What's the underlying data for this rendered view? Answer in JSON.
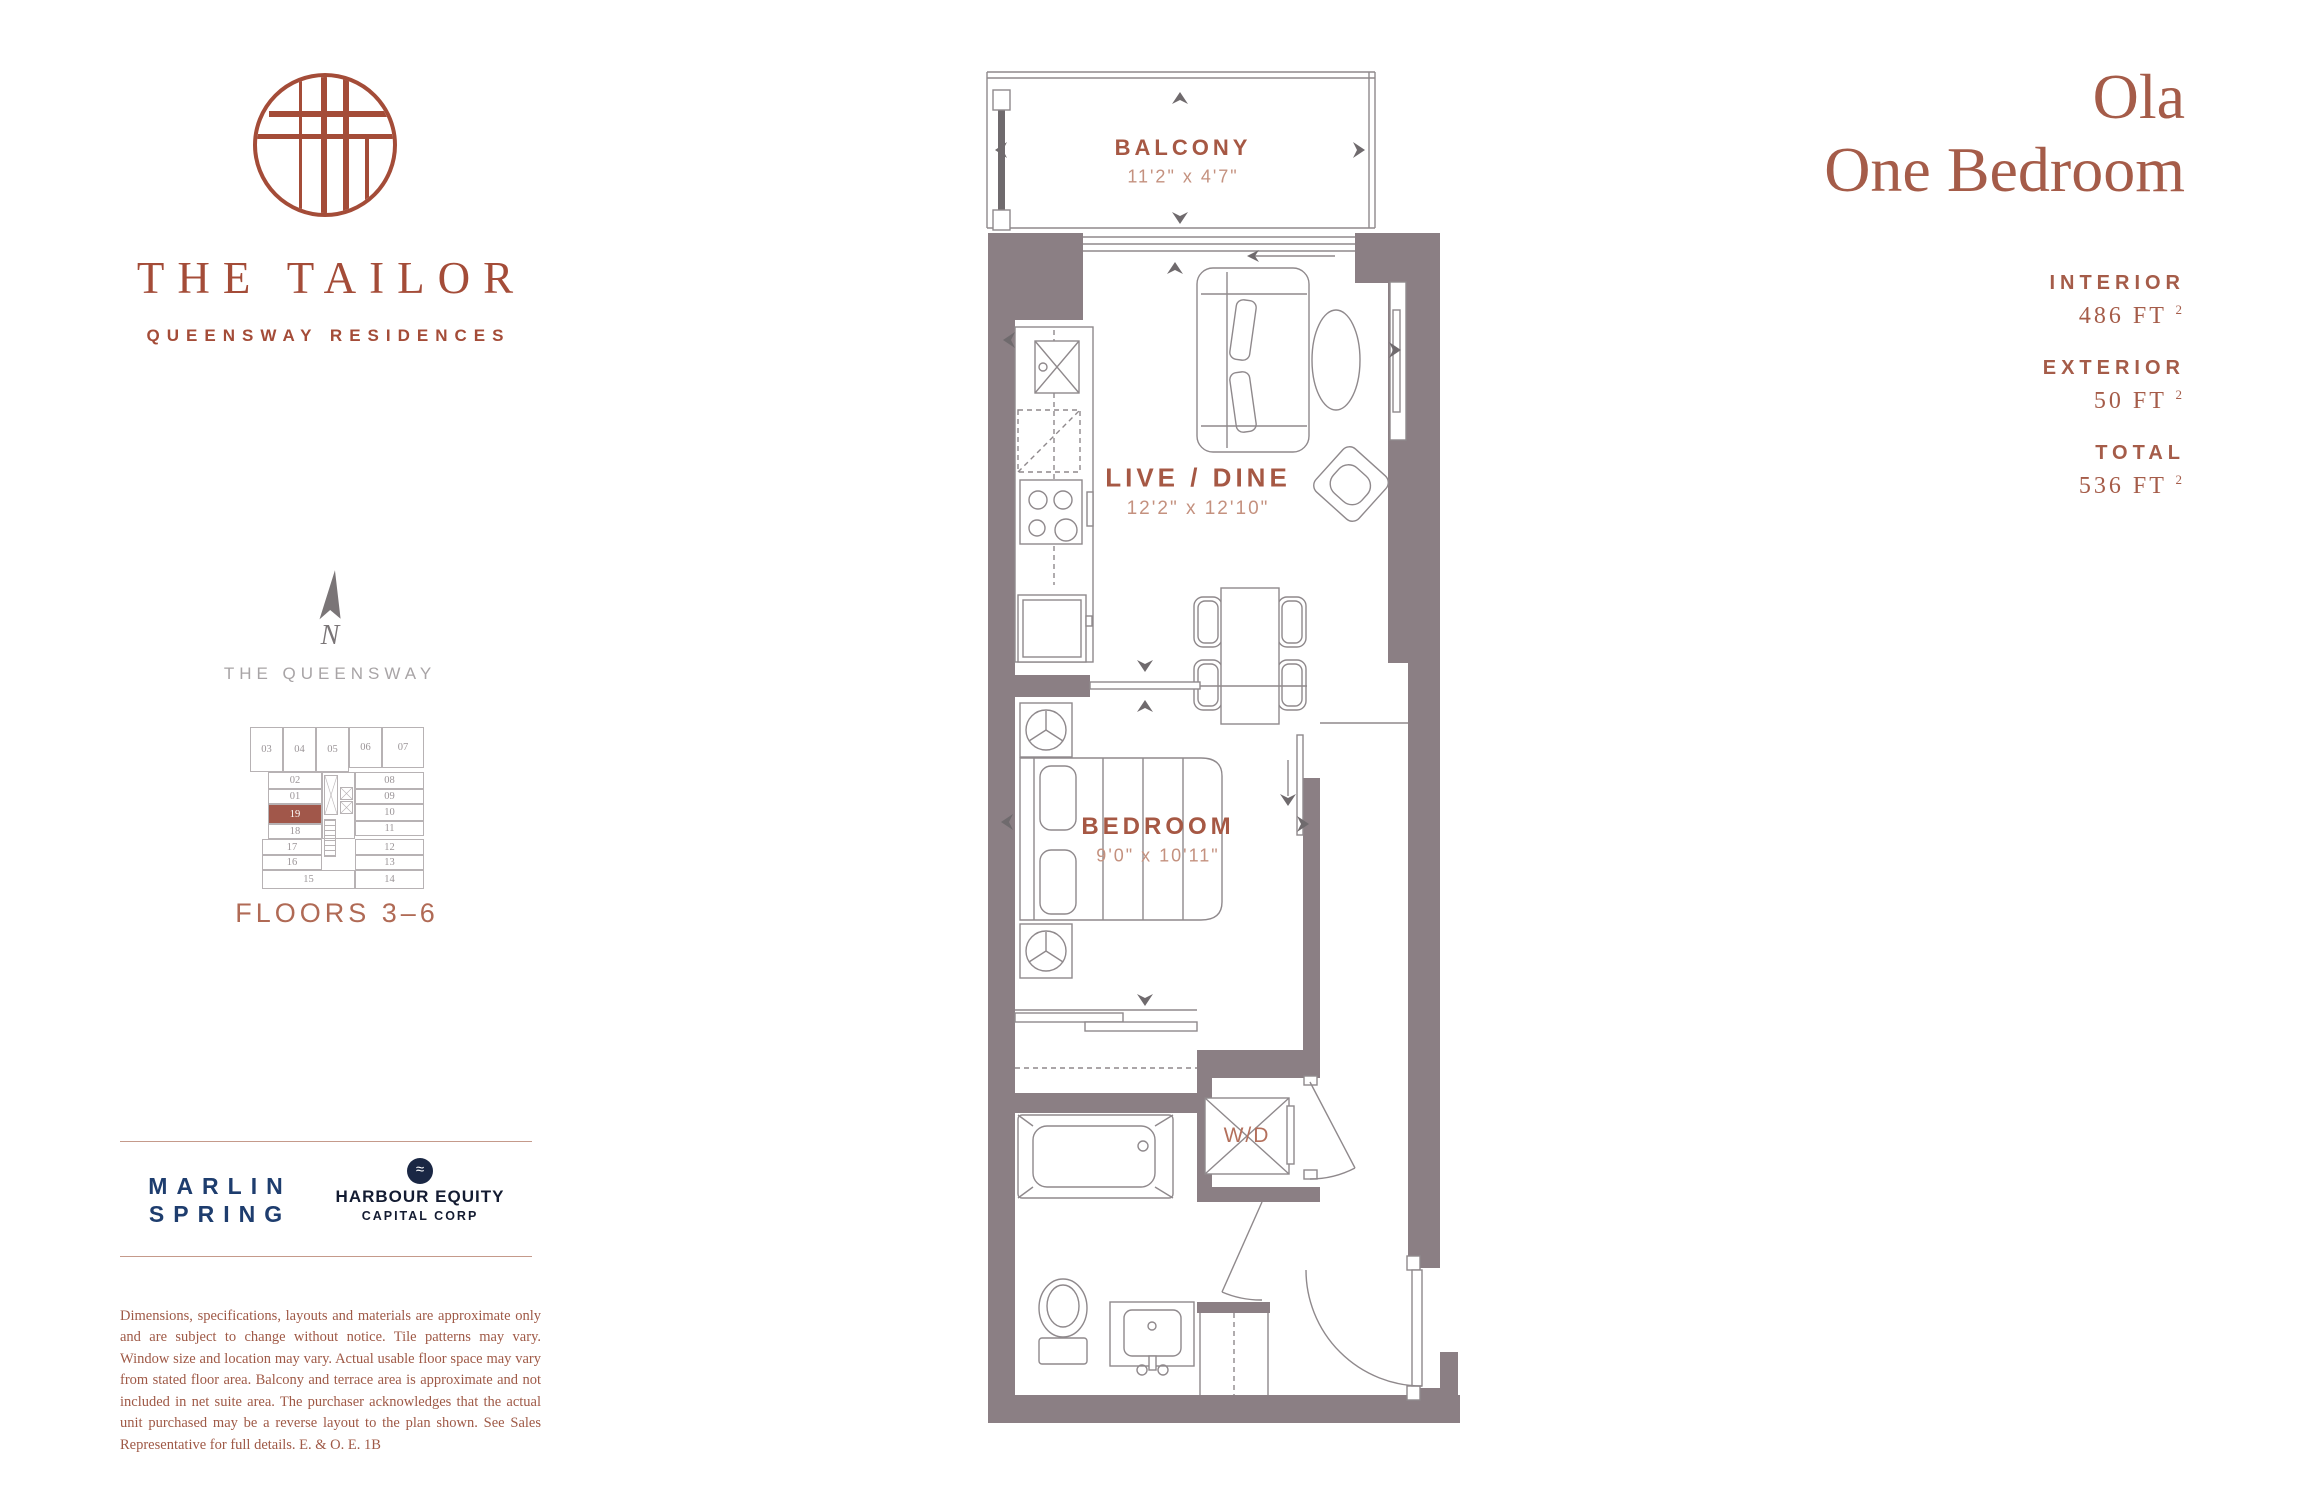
{
  "brand": {
    "name": "THE TAILOR",
    "tagline": "QUEENSWAY RESIDENCES"
  },
  "unit": {
    "name": "Ola",
    "type": "One Bedroom",
    "stats": [
      {
        "label": "INTERIOR",
        "value": "486 FT",
        "sup": "2"
      },
      {
        "label": "EXTERIOR",
        "value": "50 FT",
        "sup": "2"
      },
      {
        "label": "TOTAL",
        "value": "536 FT",
        "sup": "2"
      }
    ]
  },
  "location": {
    "compass": "N",
    "street": "THE QUEENSWAY",
    "floors": "FLOORS 3–6"
  },
  "keyplan": {
    "highlight": "19",
    "units": [
      "03",
      "04",
      "05",
      "06",
      "07",
      "02",
      "01",
      "19",
      "18",
      "17",
      "16",
      "15",
      "08",
      "09",
      "10",
      "11",
      "12",
      "13",
      "14"
    ]
  },
  "rooms": {
    "balcony": {
      "name": "BALCONY",
      "dims": "11'2\" x 4'7\""
    },
    "livedine": {
      "name": "LIVE / DINE",
      "dims": "12'2\" x 12'10\""
    },
    "bedroom": {
      "name": "BEDROOM",
      "dims": "9'0\" x 10'11\""
    },
    "laundry": {
      "name": "W/D"
    }
  },
  "developers": {
    "marlin": {
      "line1": "MARLIN",
      "line2": "SPRING"
    },
    "harbour": {
      "logo": "wave-icon",
      "wave": "≈",
      "line1": "HARBOUR EQUITY",
      "line2": "CAPITAL CORP"
    }
  },
  "disclaimer": "Dimensions, specifications, layouts and materials are approximate only and are subject to change without notice. Tile patterns may vary. Window size and location may vary. Actual usable floor space may vary from stated floor area. Balcony and terrace area is approximate and not included in net suite area. The purchaser acknowledges that the actual unit purchased may be a reverse layout to the plan shown. See Sales Representative for full details. E. & O. E. 1B",
  "colors": {
    "rust": "#a44c38",
    "wall": "#8b7f84",
    "line": "#8f898c",
    "navy": "#1e3d6e",
    "dark_navy": "#1a2744",
    "keyplan_highlight": "#a1574a"
  }
}
